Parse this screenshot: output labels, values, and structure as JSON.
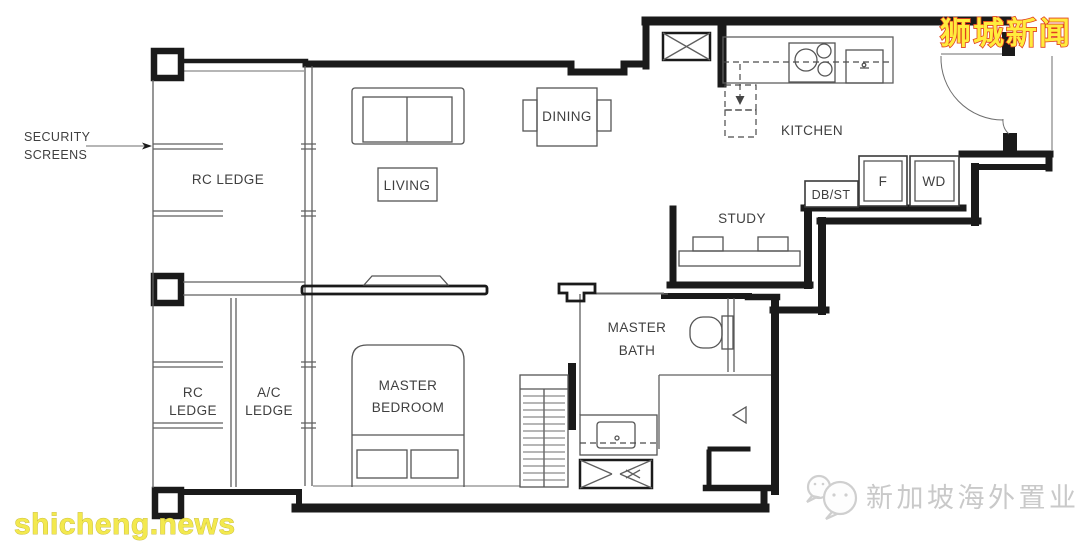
{
  "floorplan": {
    "annotations": {
      "security_line1": "SECURITY",
      "security_line2": "SCREENS"
    },
    "rooms": {
      "rc_ledge_upper": "RC LEDGE",
      "rc_lower_line1": "RC",
      "rc_lower_line2": "LEDGE",
      "ac_line1": "A/C",
      "ac_line2": "LEDGE",
      "living": "LIVING",
      "dining": "DINING",
      "kitchen": "KITCHEN",
      "study": "STUDY",
      "db_st": "DB/ST",
      "f": "F",
      "wd": "WD",
      "bath_line1": "MASTER",
      "bath_line2": "BATH",
      "bedroom_line1": "MASTER",
      "bedroom_line2": "BEDROOM"
    },
    "watermarks": {
      "top_right": "狮城新闻",
      "bottom_left": "shicheng.news",
      "bottom_right": "新加坡海外置业"
    },
    "colors": {
      "wall": "#1a1a1a",
      "thin_line": "#5f5f5f",
      "label_text": "#3f3f3f",
      "wm_top_right_fill": "#ffec3d",
      "wm_top_right_outline": "#e0401e",
      "wm_bottom_left_fill": "#f3e94e",
      "wm_agency_gray": "#c9c9c9"
    }
  }
}
